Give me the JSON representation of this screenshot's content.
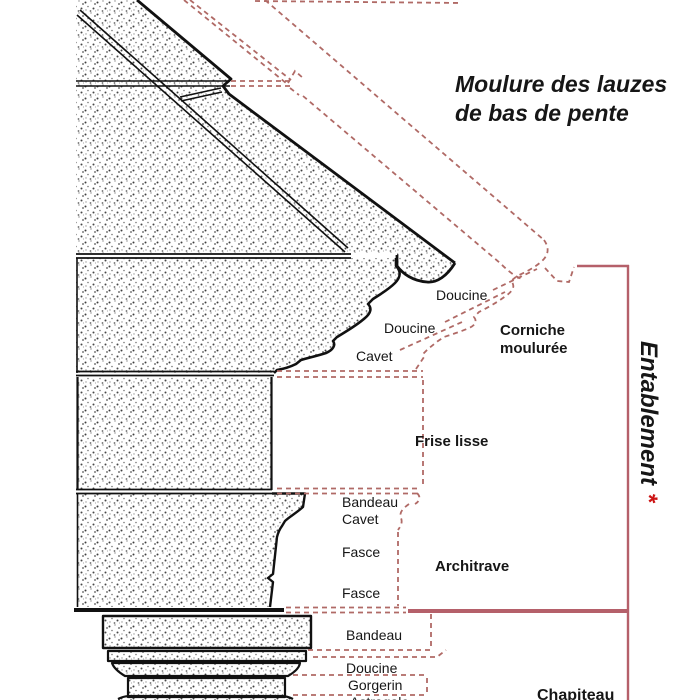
{
  "title": {
    "line1": "Moulure des lauzes",
    "line2": "de bas de pente"
  },
  "cornice": {
    "name_line1": "Corniche",
    "name_line2": "moulurée",
    "molding_doucine_upper": "Doucine",
    "molding_doucine_lower": "Doucine",
    "molding_cavet": "Cavet"
  },
  "frieze": {
    "name": "Frise lisse"
  },
  "architrave": {
    "name": "Architrave",
    "molding_bandeau": "Bandeau",
    "molding_cavet": "Cavet",
    "molding_fasce_upper": "Fasce",
    "molding_fasce_lower": "Fasce"
  },
  "capital": {
    "name": "Chapiteau",
    "molding_bandeau": "Bandeau",
    "molding_doucine": "Doucine",
    "molding_gorgerin": "Gorgerin",
    "molding_astragale": "Astragale"
  },
  "bracket": {
    "label": "Entablement",
    "asterisk": "*"
  },
  "colors": {
    "ink": "#111111",
    "dashed_red": "#b06a66",
    "bracket_red": "#b5606a",
    "asterisk_red": "#cc1414",
    "paper": "#ffffff"
  }
}
